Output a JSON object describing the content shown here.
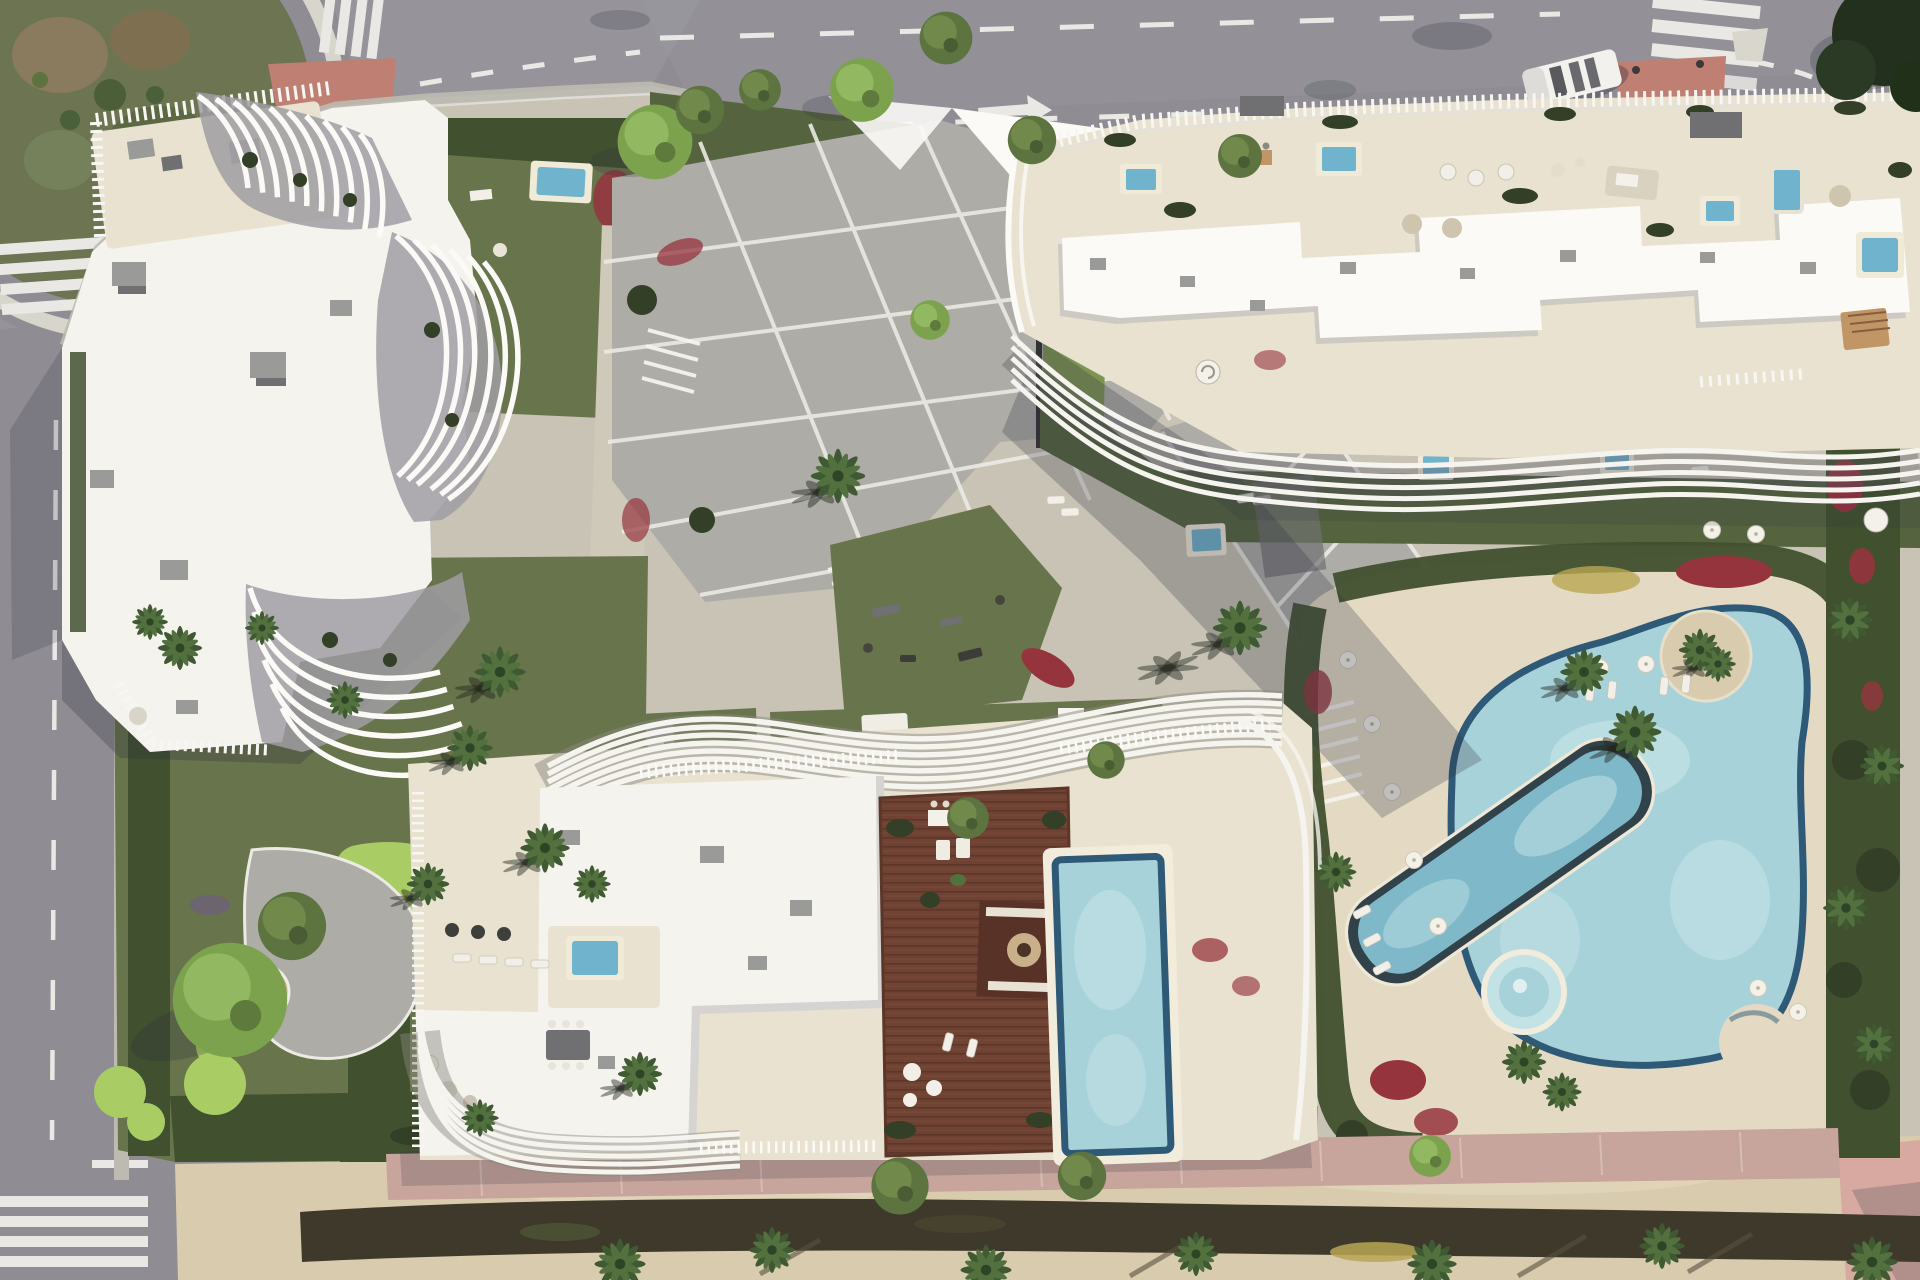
{
  "palette": {
    "asphalt": "#8f8d93",
    "asphaltLight": "#9c9aa1",
    "sidewalk": "#bdbab1",
    "curb": "#dddbd4",
    "roadLine": "#e9e8e4",
    "redPaving": "#bf7f72",
    "roundaboutRing": "#d8d5cc",
    "roundaboutGreen": "#6d7452",
    "roundBrown": "#8a7a5e",
    "parcelBase": "#c8c3b5",
    "lawn": "#68744b",
    "lawnDark": "#55643f",
    "lawnBright": "#7e9454",
    "golfBright": "#a9cd64",
    "hedge": "#41502f",
    "hedgeDark": "#343f27",
    "treeGreen": "#5d7340",
    "treeBright": "#7da24e",
    "palmGreen": "#3f5a33",
    "flowerRed": "#96343e",
    "flowerPurple": "#6f5a86",
    "flowerYellow": "#b8a653",
    "pavingGray": "#aeaca7",
    "pavingLight": "#cfc9ba",
    "plazaLine": "#eceae4",
    "white": "#f5f3ee",
    "whiteBright": "#fbfaf7",
    "buildingShade": "#b7b5b8",
    "finGap": "#a09ea3",
    "cream": "#e9e2d0",
    "creamDeep": "#e4dac4",
    "poolWater": "#a8d2da",
    "poolLight": "#c3e2e6",
    "poolDark": "#2e5a78",
    "poolPlunge": "#6fb3cc",
    "lapWater": "#7fb9c9",
    "wood": "#6f4233",
    "woodDark": "#583226",
    "sand": "#d9cbae",
    "sandLight": "#e3d7bc",
    "sandHedge": "#3e392b",
    "pinkPath": "#c7a49c",
    "pinkCorner": "#d7a9a0",
    "shadow": "#2e3140",
    "grayBox": "#9a9a98",
    "grayDark": "#707072",
    "black": "#1c1c1c"
  }
}
